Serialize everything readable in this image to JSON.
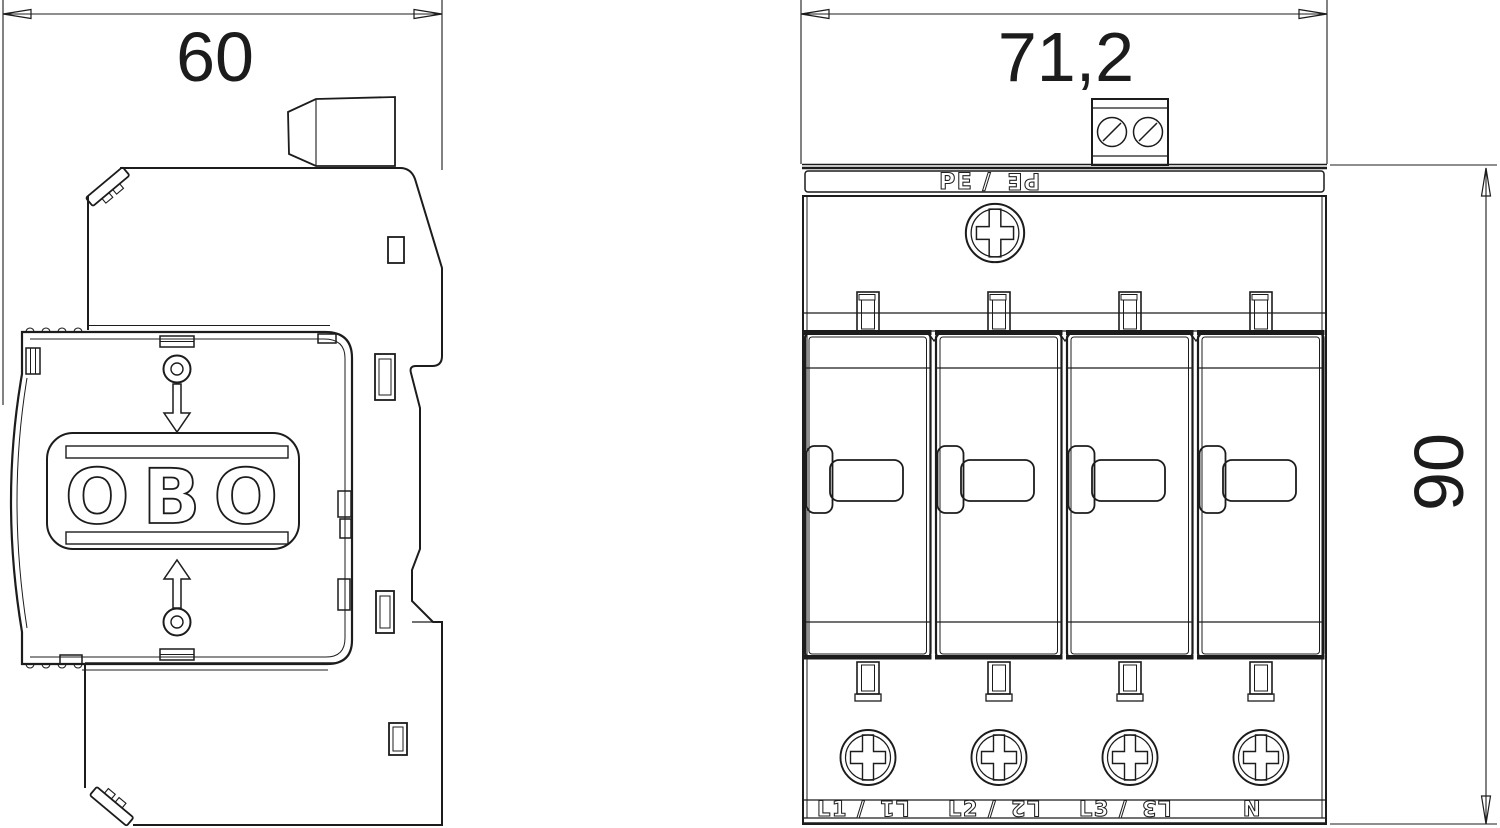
{
  "drawing": {
    "colors": {
      "line": "#1c1c1c",
      "background": "#ffffff"
    },
    "side_view": {
      "width_dim": "60",
      "logo": "OBO"
    },
    "front_view": {
      "width_dim": "71,2",
      "height_dim": "90",
      "pe_label": {
        "left": "PE /",
        "right": "PE"
      },
      "terminals": [
        {
          "left": "L1 /",
          "right": "L1"
        },
        {
          "left": "L2 /",
          "right": "L2"
        },
        {
          "left": "L3 /",
          "right": "L3"
        },
        {
          "left": "N",
          "right": ""
        }
      ]
    }
  }
}
